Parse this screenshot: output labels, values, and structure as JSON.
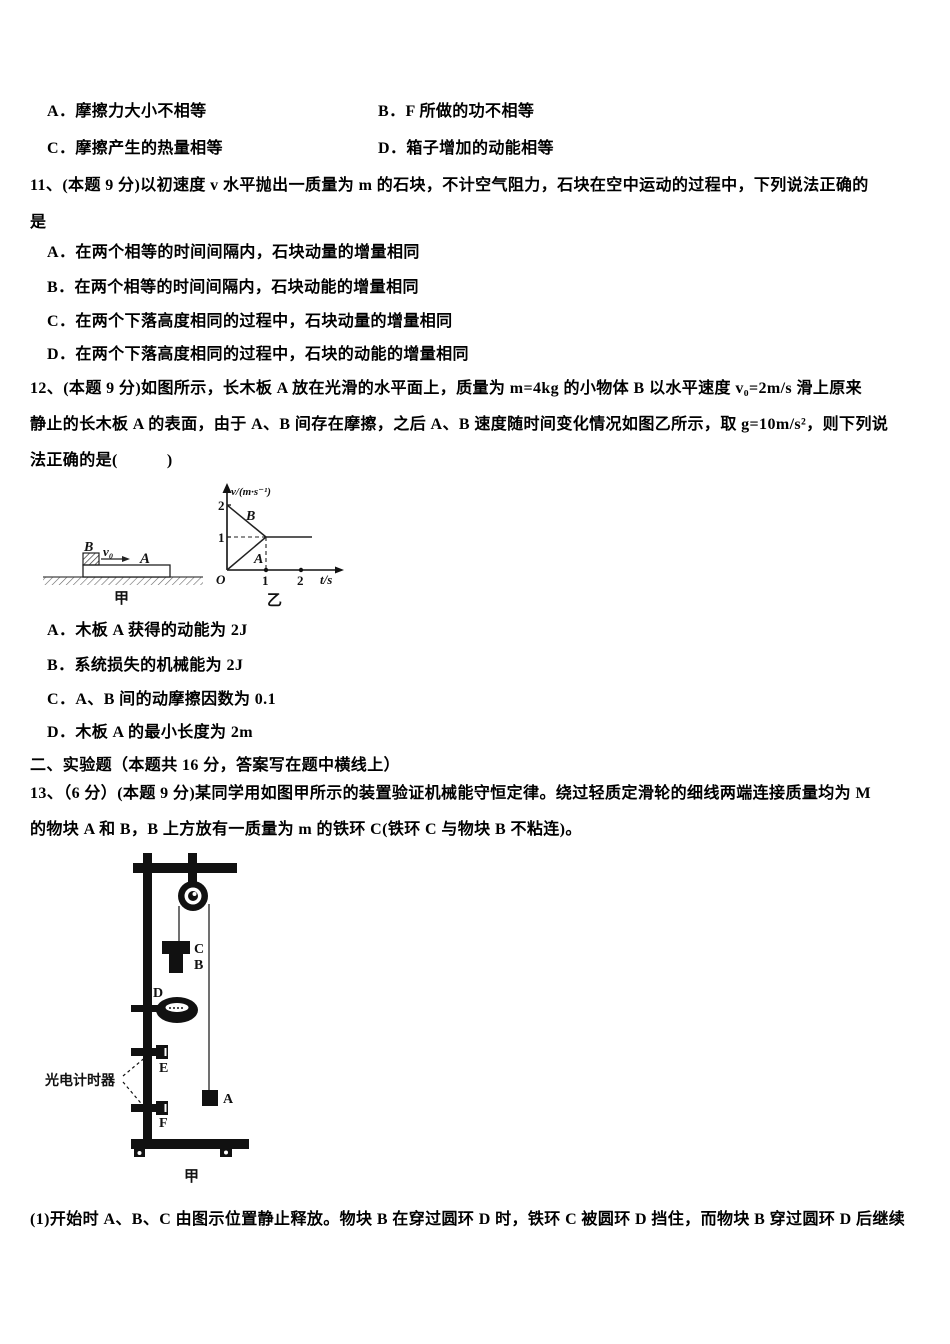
{
  "page": {
    "background": "#ffffff",
    "text_color": "#000000"
  },
  "prev_question": {
    "options": [
      "A．摩擦力大小不相等",
      "B．F 所做的功不相等",
      "C．摩擦产生的热量相等",
      "D．箱子增加的动能相等"
    ]
  },
  "q11": {
    "stem_line1": "11、(本题 9 分)以初速度 v 水平抛出一质量为 m 的石块，不计空气阻力，石块在空中运动的过程中，下列说法正确的",
    "stem_line2": "是",
    "options": [
      "A．在两个相等的时间间隔内，石块动量的增量相同",
      "B．在两个相等的时间间隔内，石块动能的增量相同",
      "C．在两个下落高度相同的过程中，石块动量的增量相同",
      "D．在两个下落高度相同的过程中，石块的动能的增量相同"
    ]
  },
  "q12": {
    "stem_line1": "12、(本题 9 分)如图所示，长木板 A 放在光滑的水平面上，质量为 m=4kg 的小物体 B 以水平速度 v₀=2m/s 滑上原来",
    "stem_line2": "静止的长木板 A 的表面，由于 A、B 间存在摩擦，之后 A、B 速度随时间变化情况如图乙所示，取 g=10m/s²，则下列说",
    "stem_line3": "法正确的是(　　　)",
    "options": [
      "A．木板 A 获得的动能为 2J",
      "B．系统损失的机械能为 2J",
      "C．A、B 间的动摩擦因数为 0.1",
      "D．木板 A 的最小长度为 2m"
    ]
  },
  "fig_jia": {
    "block_label": "B",
    "velocity_label": "v₀",
    "board_label": "A",
    "caption": "甲"
  },
  "fig_yi": {
    "ylabel": "v/(m·s⁻¹)",
    "ytick2": "2",
    "ytick1": "1",
    "origin": "O",
    "xtick1": "1",
    "xtick2": "2",
    "xlabel": "t/s",
    "line_b_label": "B",
    "line_a_label": "A",
    "caption": "乙"
  },
  "section2": {
    "title": "二、实验题（本题共 16 分，答案写在题中横线上）"
  },
  "q13": {
    "stem_line1": "13、（6 分）(本题 9 分)某同学用如图甲所示的装置验证机械能守恒定律。绕过轻质定滑轮的细线两端连接质量均为 M",
    "stem_line2": "的物块 A 和 B，B 上方放有一质量为 m 的铁环 C(铁环 C 与物块 B 不粘连)。",
    "part1": "(1)开始时 A、B、C 由图示位置静止释放。物块 B 在穿过圆环 D 时，铁环 C 被圆环 D 挡住，而物块 B 穿过圆环 D 后继续"
  },
  "fig_apparatus": {
    "timer_label": "光电计时器",
    "labels": {
      "c": "C",
      "b": "B",
      "d": "D",
      "e": "E",
      "f": "F",
      "a": "A"
    },
    "caption": "甲"
  },
  "chart_data": {
    "type": "line",
    "title": "乙",
    "xlabel": "t/s",
    "ylabel": "v/(m·s⁻¹)",
    "xlim": [
      0,
      2.4
    ],
    "ylim": [
      0,
      2.4
    ],
    "xticks": [
      1,
      2
    ],
    "yticks": [
      1,
      2
    ],
    "grid": false,
    "series": [
      {
        "name": "B",
        "x": [
          0,
          1,
          2.1
        ],
        "y": [
          2,
          1,
          1
        ]
      },
      {
        "name": "A",
        "x": [
          0,
          1,
          2.1
        ],
        "y": [
          0,
          1,
          1
        ]
      }
    ],
    "dashed_guides": {
      "t": 1,
      "v": 1
    }
  }
}
